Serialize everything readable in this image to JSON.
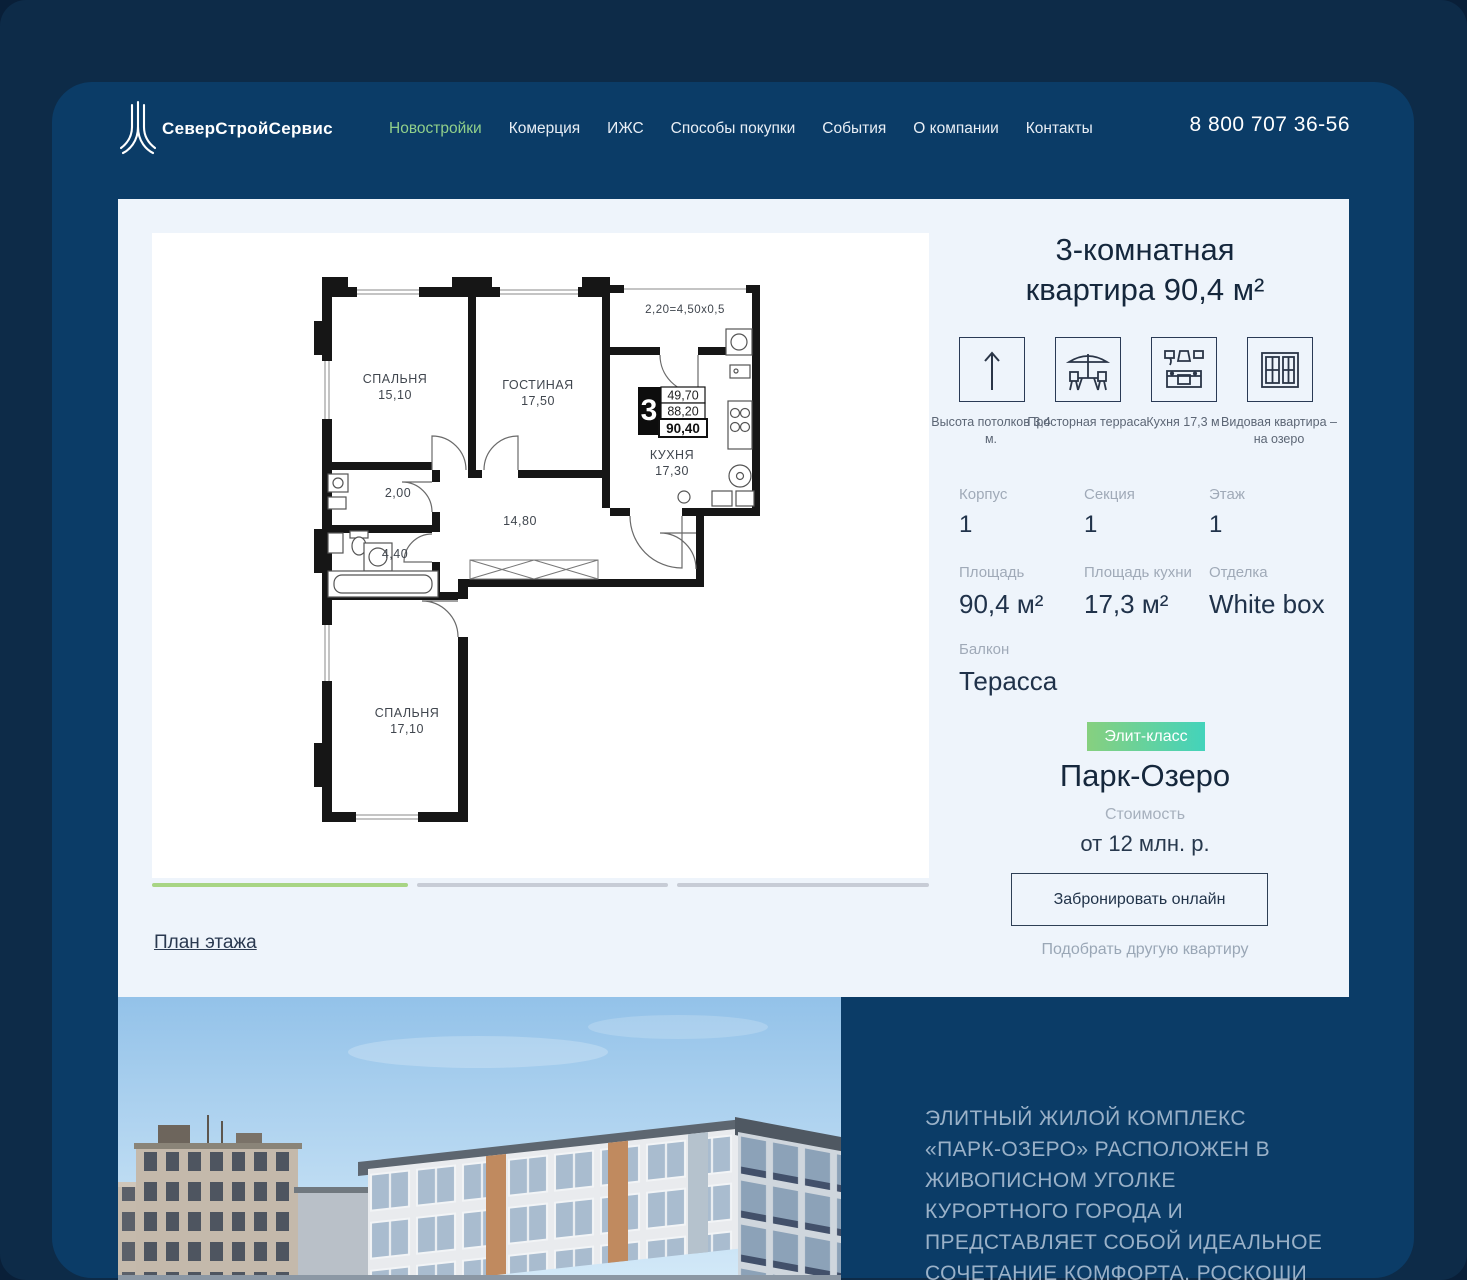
{
  "header": {
    "logo_text": "СеверСтройСервис",
    "nav": [
      {
        "label": "Новостройки",
        "active": true
      },
      {
        "label": "Комерция",
        "active": false
      },
      {
        "label": "ИЖС",
        "active": false
      },
      {
        "label": "Способы покупки",
        "active": false
      },
      {
        "label": "События",
        "active": false
      },
      {
        "label": "О компании",
        "active": false
      },
      {
        "label": "Контакты",
        "active": false
      }
    ],
    "phone": "8 800 707 36-56"
  },
  "floor_plan": {
    "bedroom1_name": "СПАЛЬНЯ",
    "bedroom1_area": "15,10",
    "living_name": "ГОСТИНАЯ",
    "living_area": "17,50",
    "kitchen_name": "КУХНЯ",
    "kitchen_area": "17,30",
    "bedroom2_name": "СПАЛЬНЯ",
    "bedroom2_area": "17,10",
    "bath_area": "2,00",
    "wc_area": "4,40",
    "hall_area": "14,80",
    "terrace_dim": "2,20=4,50x0,5",
    "stamp_rooms": "3",
    "stamp_living": "49,70",
    "stamp_area": "88,20",
    "stamp_total": "90,40"
  },
  "gallery": {
    "floor_plan_link": "План этажа"
  },
  "details": {
    "title_line1": "3-комнатная",
    "title_line2": "квартира 90,4 м²",
    "features": [
      {
        "icon": "ceiling-height-arrow-icon",
        "caption": "Высота потолков 3,4 м."
      },
      {
        "icon": "terrace-icon",
        "caption": "Просторная терраса"
      },
      {
        "icon": "kitchen-icon",
        "caption": "Кухня 17,3 м"
      },
      {
        "icon": "window-view-icon",
        "caption": "Видовая квартира – на озеро"
      }
    ],
    "specs": [
      {
        "label": "Корпус",
        "value": "1"
      },
      {
        "label": "Секция",
        "value": "1"
      },
      {
        "label": "Этаж",
        "value": "1"
      },
      {
        "label": "Площадь",
        "value": "90,4 м²"
      },
      {
        "label": "Площадь кухни",
        "value": "17,3 м²"
      },
      {
        "label": "Отделка",
        "value": "White box"
      },
      {
        "label": "Балкон",
        "value": "Терасса"
      }
    ],
    "badge": "Элит-класс",
    "complex_name": "Парк-Озеро",
    "price_label": "Стоимость",
    "price": "от 12 млн. р.",
    "book_button": "Забронировать онлайн",
    "other_link": "Подобрать другую квартиру"
  },
  "about": {
    "text": "ЭЛИТНЫЙ ЖИЛОЙ КОМПЛЕКС «ПАРК-ОЗЕРО» РАСПОЛОЖЕН В ЖИВОПИСНОМ УГОЛКЕ КУРОРТНОГО ГОРОДА И ПРЕДСТАВЛЯЕТ СОБОЙ ИДЕАЛЬНОЕ СОЧЕТАНИЕ КОМФОРТА, РОСКОШИ И ЕДИНЕНИЯ С ПРИРОДОЙ"
  },
  "colors": {
    "bg_base": "#091f38",
    "bg_main": "#0d2b48",
    "panel": "#0b3c67",
    "card": "#eef4fb",
    "accent_green": "#90cf8a",
    "badge_gradient_start": "#87d07f",
    "badge_gradient_end": "#43d3bb",
    "text_dark": "#20324a",
    "label_gray": "#a0aab8"
  }
}
